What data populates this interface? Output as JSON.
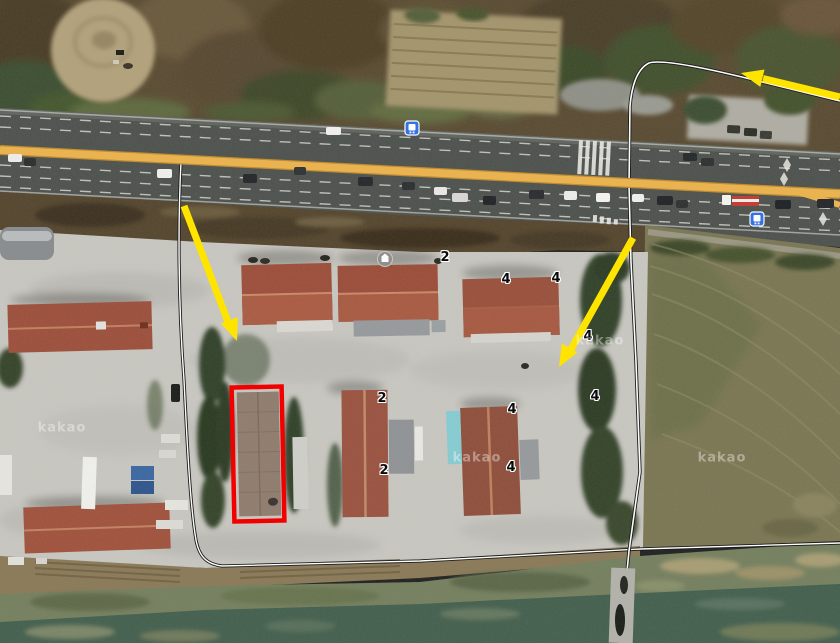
{
  "map": {
    "view": "satellite",
    "description": "aerial photo of roadside warehouse complex between a multi-lane highway and a stream"
  },
  "watermark": {
    "text": "kakao"
  },
  "markers": [
    {
      "label": "2",
      "x": 445,
      "y": 258
    },
    {
      "label": "4",
      "x": 506,
      "y": 280
    },
    {
      "label": "4",
      "x": 556,
      "y": 279
    },
    {
      "label": "4",
      "x": 588,
      "y": 337
    },
    {
      "label": "4",
      "x": 595,
      "y": 397
    },
    {
      "label": "2",
      "x": 382,
      "y": 399
    },
    {
      "label": "2",
      "x": 384,
      "y": 471
    },
    {
      "label": "4",
      "x": 512,
      "y": 410
    },
    {
      "label": "4",
      "x": 511,
      "y": 468
    }
  ],
  "annotations": {
    "highlight_box": {
      "x": 233,
      "y": 387,
      "w": 50,
      "h": 134,
      "stroke_width": 4.5,
      "color": "#f20000"
    },
    "arrow_color": "#ffe400",
    "arrows": [
      {
        "name": "arrow-down-right",
        "from_x": 184,
        "from_y": 206,
        "tip_x": 237,
        "tip_y": 341
      },
      {
        "name": "arrow-down-left",
        "from_x": 633,
        "from_y": 238,
        "tip_x": 559,
        "tip_y": 367
      },
      {
        "name": "arrow-left",
        "from_x": 840,
        "from_y": 97,
        "tip_x": 741,
        "tip_y": 73
      }
    ]
  },
  "colors": {
    "highlight_red": "#f20000",
    "arrow_yellow": "#ffe400",
    "road_overlay_orange": "#ecb34d",
    "road_overlay_orange_edge": "#c08b2e",
    "road_line_fill": "#ffffff",
    "road_line_casing": "#141414",
    "bus_icon_blue": "#2f6fe4"
  },
  "icons": [
    {
      "name": "bus-stop-icon",
      "x": 412,
      "y": 128
    },
    {
      "name": "bus-stop-icon",
      "x": 757,
      "y": 219
    },
    {
      "name": "poi-icon",
      "x": 385,
      "y": 259
    }
  ]
}
